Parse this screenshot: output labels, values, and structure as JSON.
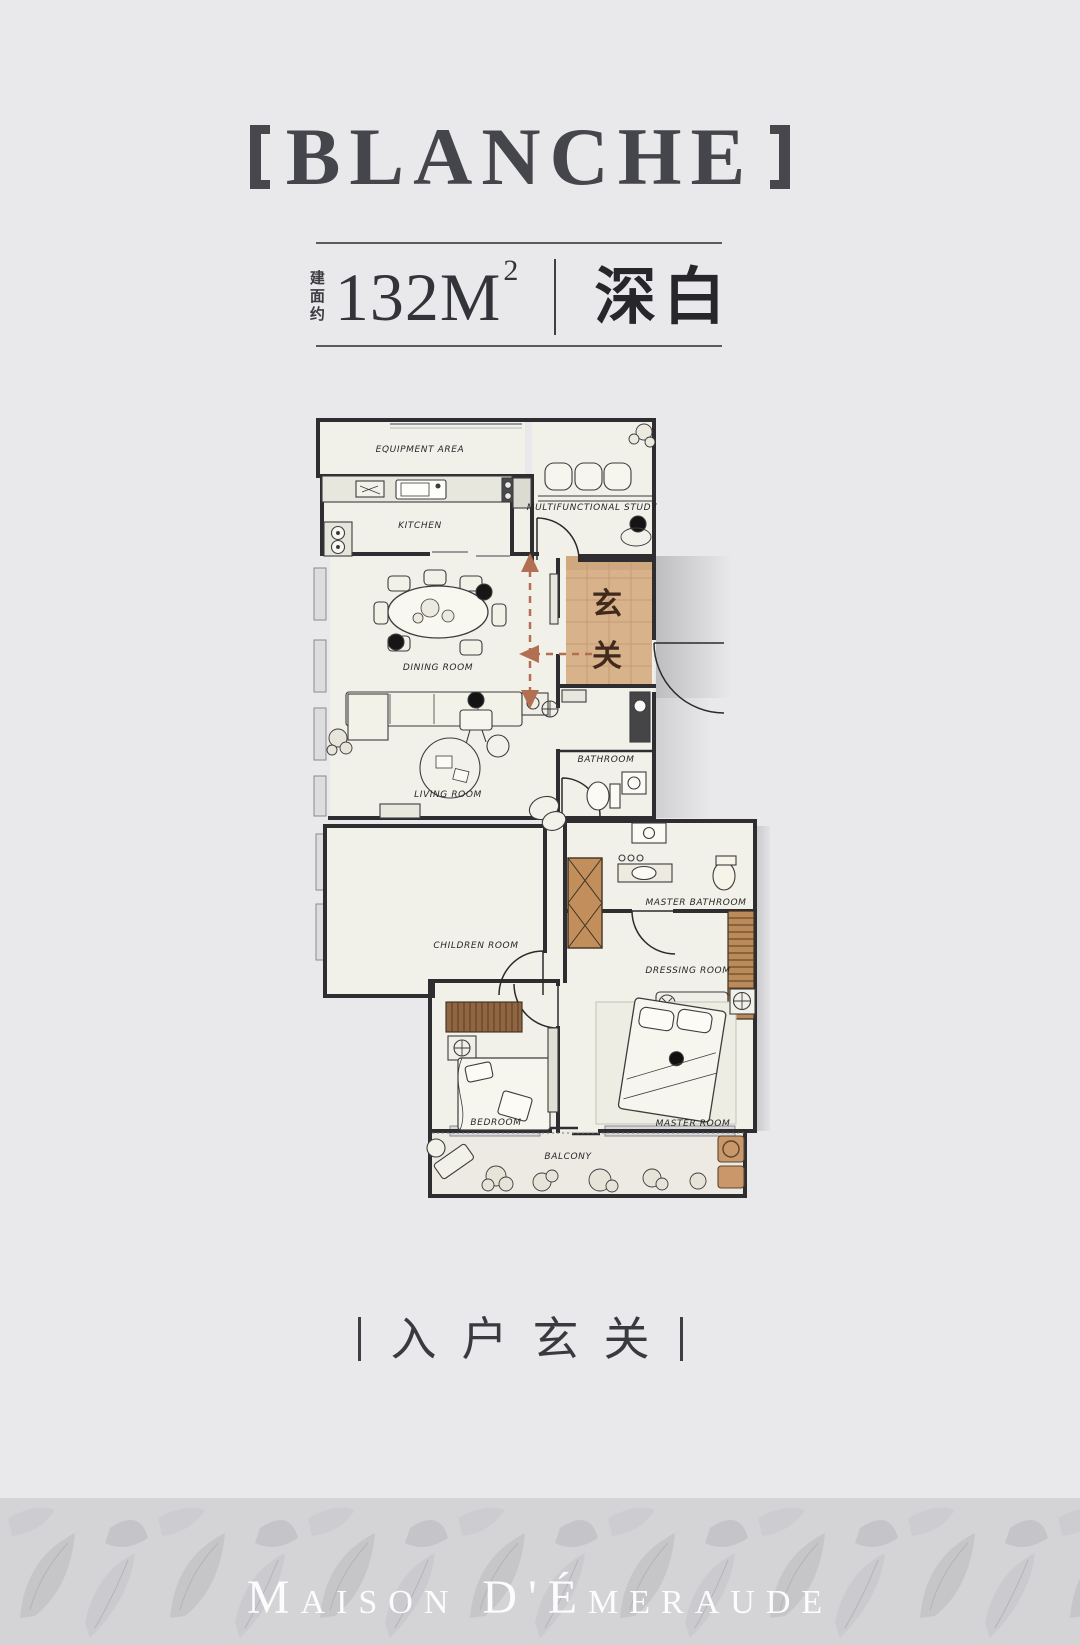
{
  "page": {
    "background": "#e9e9eb",
    "title_color": "#45454c",
    "entry_tan": "#d7b28b",
    "arrow_color": "#b26f52",
    "wall_color": "#2e2e31",
    "wood_color": "#bb8a58",
    "footer_bg": "#d5d5d7",
    "brand_text_color": "#fcfcfd"
  },
  "header": {
    "bracket_left": "【",
    "title": "BLANCHE",
    "bracket_right": "】"
  },
  "spec": {
    "area_label_vertical": "建面约",
    "area_value": "132M",
    "area_superscript": "2",
    "scheme_name": "深白"
  },
  "floorplan": {
    "entry_zone": {
      "char_top": "玄",
      "char_bottom": "关"
    },
    "rooms": {
      "equipment_area": "EQUIPMENT AREA",
      "kitchen": "KITCHEN",
      "study": "MULTIFUNCTIONAL STUDY",
      "dining": "DINING ROOM",
      "living": "LIVING ROOM",
      "bathroom": "BATHROOM",
      "master_bathroom": "MASTER BATHROOM",
      "children_room": "CHILDREN ROOM",
      "dressing_room": "DRESSING ROOM",
      "bedroom": "BEDROOM",
      "master_room": "MASTER ROOM",
      "balcony": "BALCONY"
    }
  },
  "tagline": {
    "text": "入户玄关"
  },
  "footer": {
    "brand": "Maison D'Émeraude"
  }
}
